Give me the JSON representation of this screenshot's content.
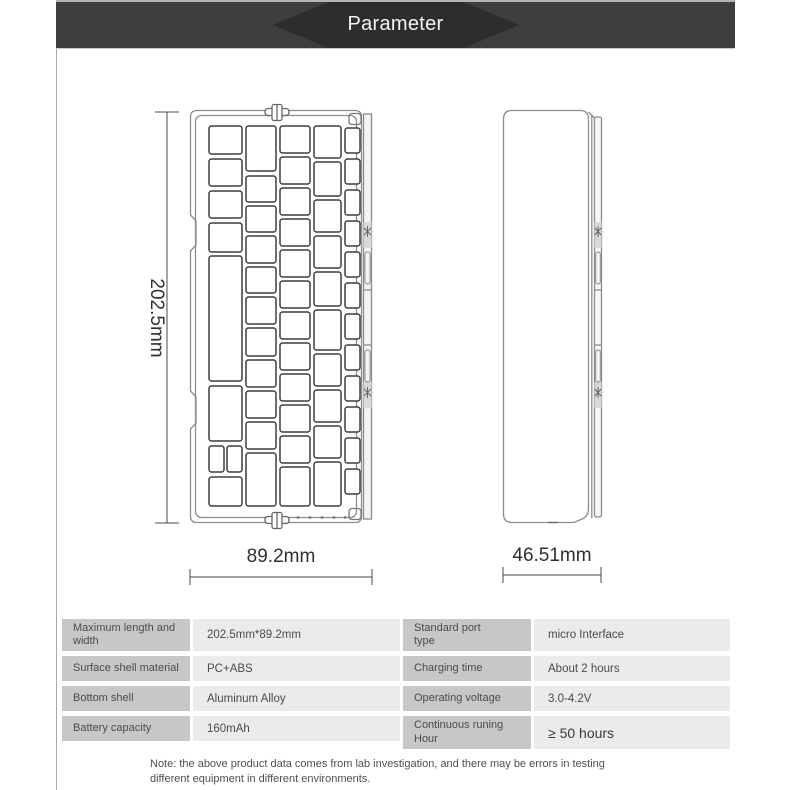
{
  "header": {
    "title": "Parameter",
    "bar_color": "#3e3e3e",
    "hexagon_color": "#2d2d2d",
    "title_color": "#f4f4f4"
  },
  "diagram": {
    "front_view": {
      "name": "keyboard front view technical drawing",
      "height_label": "202.5mm",
      "width_label": "89.2mm"
    },
    "side_view": {
      "name": "keyboard side profile technical drawing",
      "width_label": "46.51mm"
    },
    "line_color": "#8c8c8c",
    "key_line_color": "#3d3d3d",
    "dimension_color": "#4a4a4a",
    "dimension_text_color": "#2f2f2f"
  },
  "spec_table": {
    "label_cell_bg": "#c7c7c7",
    "value_cell_bg": "#ebebeb",
    "left_rows": [
      {
        "label": "Maximum length and\nwidth",
        "value": "202.5mm*89.2mm"
      },
      {
        "label": "Surface shell material",
        "value": "PC+ABS"
      },
      {
        "label": "Bottom shell",
        "value": "Aluminum Alloy"
      },
      {
        "label": "Battery capacity",
        "value": "160mAh"
      }
    ],
    "right_rows": [
      {
        "label": "Standard port\ntype",
        "value": "micro Interface"
      },
      {
        "label": "Charging time",
        "value": "About 2 hours"
      },
      {
        "label": "Operating voltage",
        "value": "3.0-4.2V"
      },
      {
        "label": "Continuous runing Hour",
        "value": "≥ 50 hours",
        "emphasis": true
      }
    ]
  },
  "note": "Note: the above product data comes from lab investigation, and there may be errors in testing different equipment in different environments."
}
